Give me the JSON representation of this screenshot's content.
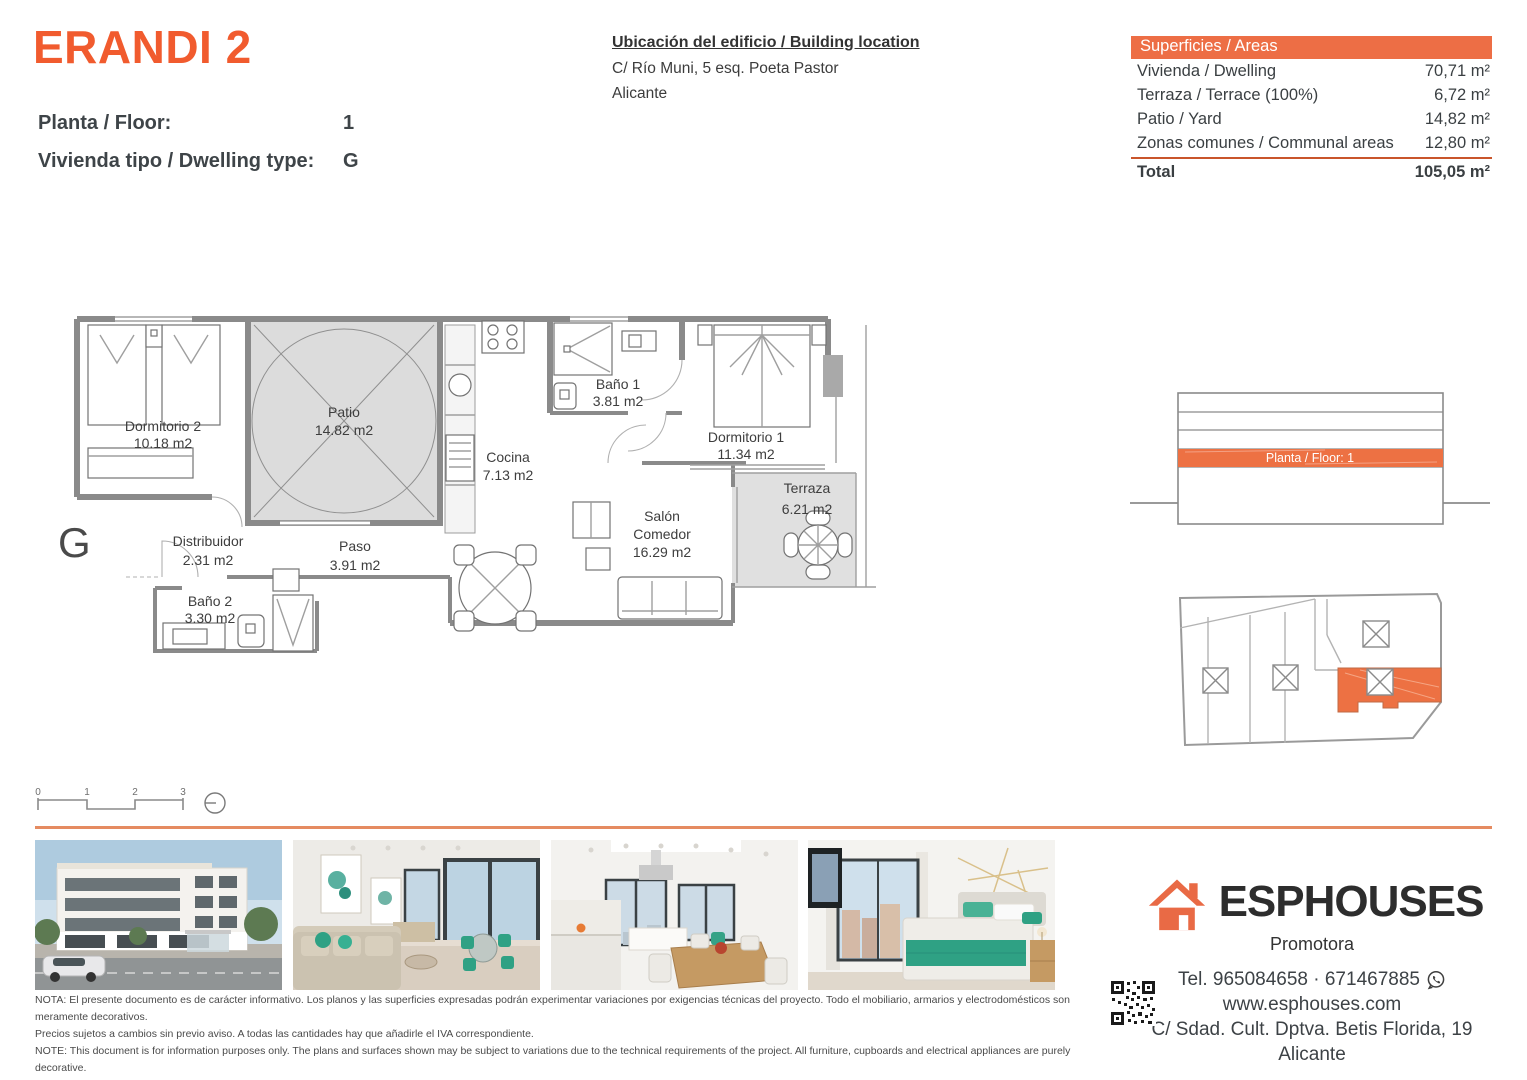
{
  "page_title": "ERANDI 2",
  "header": {
    "project_title": "ERANDI 2",
    "floor_label": "Planta / Floor:",
    "floor_value": "1",
    "dwelling_label": "Vivienda tipo / Dwelling type:",
    "dwelling_value": "G"
  },
  "location": {
    "title": "Ubicación del edificio / Building location",
    "line1": "C/ Río Muni, 5 esq. Poeta Pastor",
    "line2": "Alicante"
  },
  "areas_table": {
    "header": "Superficies / Areas",
    "rows": [
      {
        "label": "Vivienda / Dwelling",
        "value": "70,71 m²"
      },
      {
        "label": "Terraza / Terrace (100%)",
        "value": "6,72 m²"
      },
      {
        "label": "Patio / Yard",
        "value": "14,82 m²"
      },
      {
        "label": "Zonas comunes / Communal areas",
        "value": "12,80 m²"
      }
    ],
    "total_label": "Total",
    "total_value": "105,05 m²"
  },
  "floorplan": {
    "type_letter": "G",
    "rooms": [
      {
        "name": "Dormitorio 2",
        "area": "10.18 m2"
      },
      {
        "name": "Patio",
        "area": "14.82 m2"
      },
      {
        "name": "Cocina",
        "area": "7.13 m2"
      },
      {
        "name": "Baño 1",
        "area": "3.81 m2"
      },
      {
        "name": "Dormitorio 1",
        "area": "11.34 m2"
      },
      {
        "name": "Terraza",
        "area": "6.21 m2"
      },
      {
        "name": "Distribuidor",
        "area": "2.31 m2"
      },
      {
        "name": "Paso",
        "area": "3.91 m2"
      },
      {
        "name": "Baño 2",
        "area": "3.30 m2"
      },
      {
        "name": "Salón",
        "name2": "Comedor",
        "area": "16.29 m2"
      }
    ]
  },
  "scale_bar": {
    "labels": [
      "0",
      "1",
      "2",
      "3"
    ]
  },
  "elevation": {
    "highlight_label": "Planta / Floor: 1"
  },
  "footer": {
    "brand": "ESPHOUSES",
    "brand_sub": "Promotora",
    "phone": "Tel. 965084658 · 671467885",
    "web": "www.esphouses.com",
    "address1": "C/ Sdad. Cult. Dptva. Betis Florida, 19",
    "address2": "Alicante",
    "notes": [
      "NOTA: El presente documento es de carácter informativo. Los planos y las superficies expresadas podrán experimentar variaciones por exigencias técnicas del proyecto. Todo el mobiliario, armarios y electrodomésticos son meramente decorativos.",
      "Precios sujetos a cambios sin previo aviso. A todas las cantidades hay que añadirle el IVA correspondiente.",
      "NOTE: This document is for information purposes only. The plans and surfaces shown may be subject to variations due to the technical requirements of the project. All furniture, cupboards and electrical appliances are purely decorative.",
      "Prices subject to change without notice. VAT must be added to all amounts."
    ]
  },
  "colors": {
    "accent_orange": "#ED6E45",
    "title_orange": "#F15B2E",
    "table_rule": "#C9552B",
    "separator": "#E58B61",
    "highlight_fill": "#ED7143"
  }
}
